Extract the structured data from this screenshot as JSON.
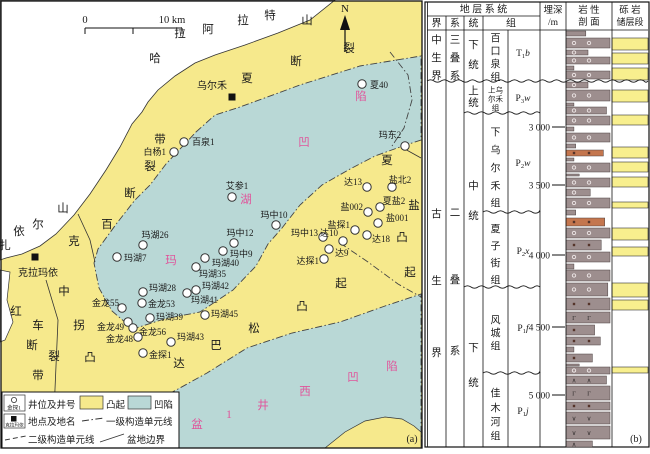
{
  "colors": {
    "uplift_yellow": "#f6e98c",
    "sag_blue": "#b9d8d6",
    "pink_label": "#e0559b",
    "congl_gray": "#9d8e8e",
    "congl_orange": "#c4764e",
    "reservoir_yellow": "#f8ef8e",
    "line_black": "#333333"
  },
  "map": {
    "panel_label": "(a)",
    "north_label": "N",
    "scale": {
      "zero": "0",
      "ten": "10 km"
    },
    "towns": [
      {
        "name": "乌尔禾",
        "x": 232,
        "y": 97,
        "lx": 212,
        "ly": 89
      },
      {
        "name": "克拉玛依",
        "x": 35,
        "y": 257,
        "lx": 38,
        "ly": 276
      }
    ],
    "wells": [
      {
        "n": "夏40",
        "x": 362,
        "y": 84,
        "lx": 370,
        "ly": 88,
        "a": "start"
      },
      {
        "n": "百泉1",
        "x": 184,
        "y": 142,
        "lx": 192,
        "ly": 145,
        "a": "start"
      },
      {
        "n": "白杨1",
        "x": 174,
        "y": 152,
        "lx": 166,
        "ly": 155,
        "a": "end"
      },
      {
        "n": "艾参1",
        "x": 232,
        "y": 197,
        "lx": 237,
        "ly": 189,
        "a": "middle"
      },
      {
        "n": "玛东2",
        "x": 405,
        "y": 146,
        "lx": 390,
        "ly": 138,
        "a": "middle"
      },
      {
        "n": "玛湖26",
        "x": 143,
        "y": 245,
        "lx": 155,
        "ly": 238,
        "a": "middle"
      },
      {
        "n": "玛中12",
        "x": 234,
        "y": 243,
        "lx": 240,
        "ly": 236,
        "a": "middle"
      },
      {
        "n": "玛中9",
        "x": 223,
        "y": 251,
        "lx": 230,
        "ly": 257,
        "a": "start"
      },
      {
        "n": "玛湖40",
        "x": 205,
        "y": 258,
        "lx": 212,
        "ly": 266,
        "a": "start"
      },
      {
        "n": "玛湖35",
        "x": 196,
        "y": 267,
        "lx": 199,
        "ly": 277,
        "a": "start"
      },
      {
        "n": "玛湖7",
        "x": 117,
        "y": 257,
        "lx": 124,
        "ly": 261,
        "a": "start"
      },
      {
        "n": "玛湖28",
        "x": 143,
        "y": 292,
        "lx": 149,
        "ly": 291,
        "a": "start"
      },
      {
        "n": "玛湖42",
        "x": 196,
        "y": 290,
        "lx": 202,
        "ly": 289,
        "a": "start"
      },
      {
        "n": "玛湖41",
        "x": 187,
        "y": 293,
        "lx": 191,
        "ly": 303,
        "a": "start"
      },
      {
        "n": "金龙55",
        "x": 122,
        "y": 308,
        "lx": 119,
        "ly": 306,
        "a": "end"
      },
      {
        "n": "金龙53",
        "x": 142,
        "y": 303,
        "lx": 148,
        "ly": 307,
        "a": "start"
      },
      {
        "n": "玛湖39",
        "x": 150,
        "y": 318,
        "lx": 156,
        "ly": 320,
        "a": "start"
      },
      {
        "n": "玛湖45",
        "x": 205,
        "y": 315,
        "lx": 211,
        "ly": 317,
        "a": "start"
      },
      {
        "n": "金龙49",
        "x": 128,
        "y": 322,
        "lx": 124,
        "ly": 330,
        "a": "end"
      },
      {
        "n": "金龙56",
        "x": 133,
        "y": 328,
        "lx": 139,
        "ly": 335,
        "a": "start"
      },
      {
        "n": "金龙48",
        "x": 138,
        "y": 337,
        "lx": 133,
        "ly": 342,
        "a": "end"
      },
      {
        "n": "玛湖43",
        "x": 171,
        "y": 342,
        "lx": 177,
        "ly": 340,
        "a": "start"
      },
      {
        "n": "金探1",
        "x": 143,
        "y": 353,
        "lx": 149,
        "ly": 358,
        "a": "start"
      },
      {
        "n": "玛中10",
        "x": 276,
        "y": 225,
        "lx": 274,
        "ly": 218,
        "a": "middle"
      },
      {
        "n": "玛中13",
        "x": 323,
        "y": 237,
        "lx": 318,
        "ly": 236,
        "a": "end"
      },
      {
        "n": "达13",
        "x": 367,
        "y": 187,
        "lx": 362,
        "ly": 185,
        "a": "end"
      },
      {
        "n": "盐北2",
        "x": 392,
        "y": 187,
        "lx": 400,
        "ly": 183,
        "a": "middle"
      },
      {
        "n": "盐002",
        "x": 368,
        "y": 212,
        "lx": 363,
        "ly": 210,
        "a": "end"
      },
      {
        "n": "夏盐2",
        "x": 380,
        "y": 207,
        "lx": 394,
        "ly": 204,
        "a": "middle"
      },
      {
        "n": "盐001",
        "x": 378,
        "y": 223,
        "lx": 386,
        "ly": 221,
        "a": "start"
      },
      {
        "n": "盐探1",
        "x": 355,
        "y": 230,
        "lx": 350,
        "ly": 228,
        "a": "end"
      },
      {
        "n": "达10",
        "x": 343,
        "y": 241,
        "lx": 338,
        "ly": 236,
        "a": "end"
      },
      {
        "n": "达18",
        "x": 367,
        "y": 235,
        "lx": 372,
        "ly": 242,
        "a": "start"
      },
      {
        "n": "达9",
        "x": 329,
        "y": 249,
        "lx": 335,
        "ly": 256,
        "a": "start"
      },
      {
        "n": "达探1",
        "x": 324,
        "y": 259,
        "lx": 319,
        "ly": 264,
        "a": "end"
      }
    ],
    "labels": [
      {
        "t": "哈",
        "x": 155,
        "y": 62,
        "c": "k"
      },
      {
        "t": "拉",
        "x": 180,
        "y": 37,
        "c": "k"
      },
      {
        "t": "阿",
        "x": 208,
        "y": 33,
        "c": "k"
      },
      {
        "t": "拉",
        "x": 243,
        "y": 24,
        "c": "k"
      },
      {
        "t": "特",
        "x": 270,
        "y": 19,
        "c": "k"
      },
      {
        "t": "山",
        "x": 307,
        "y": 24,
        "c": "k"
      },
      {
        "t": "扎",
        "x": 5,
        "y": 249,
        "c": "k"
      },
      {
        "t": "依",
        "x": 19,
        "y": 235,
        "c": "k"
      },
      {
        "t": "尔",
        "x": 38,
        "y": 228,
        "c": "k"
      },
      {
        "t": "山",
        "x": 63,
        "y": 212,
        "c": "k"
      },
      {
        "t": "克",
        "x": 74,
        "y": 245,
        "c": "k"
      },
      {
        "t": "百",
        "x": 107,
        "y": 228,
        "c": "k"
      },
      {
        "t": "断",
        "x": 130,
        "y": 197,
        "c": "k"
      },
      {
        "t": "裂",
        "x": 150,
        "y": 170,
        "c": "k"
      },
      {
        "t": "带",
        "x": 160,
        "y": 143,
        "c": "k"
      },
      {
        "t": "夏",
        "x": 247,
        "y": 82,
        "c": "k"
      },
      {
        "t": "断",
        "x": 296,
        "y": 65,
        "c": "k"
      },
      {
        "t": "裂",
        "x": 349,
        "y": 52,
        "c": "k"
      },
      {
        "t": "红",
        "x": 16,
        "y": 315,
        "c": "k"
      },
      {
        "t": "车",
        "x": 38,
        "y": 329,
        "c": "k"
      },
      {
        "t": "断",
        "x": 32,
        "y": 349,
        "c": "k"
      },
      {
        "t": "裂",
        "x": 54,
        "y": 360,
        "c": "k"
      },
      {
        "t": "带",
        "x": 38,
        "y": 379,
        "c": "k"
      },
      {
        "t": "中",
        "x": 64,
        "y": 295,
        "c": "k"
      },
      {
        "t": "拐",
        "x": 79,
        "y": 329,
        "c": "k"
      },
      {
        "t": "凸",
        "x": 90,
        "y": 361,
        "c": "k"
      },
      {
        "t": "夏",
        "x": 387,
        "y": 164,
        "c": "k"
      },
      {
        "t": "盐",
        "x": 414,
        "y": 209,
        "c": "k"
      },
      {
        "t": "凸",
        "x": 402,
        "y": 241,
        "c": "k"
      },
      {
        "t": "起",
        "x": 410,
        "y": 276,
        "c": "k"
      },
      {
        "t": "达",
        "x": 179,
        "y": 367,
        "c": "k"
      },
      {
        "t": "巴",
        "x": 216,
        "y": 349,
        "c": "k"
      },
      {
        "t": "松",
        "x": 254,
        "y": 332,
        "c": "k"
      },
      {
        "t": "凸",
        "x": 302,
        "y": 310,
        "c": "k"
      },
      {
        "t": "起",
        "x": 341,
        "y": 287,
        "c": "k"
      },
      {
        "t": "玛",
        "x": 171,
        "y": 264,
        "c": "p"
      },
      {
        "t": "湖",
        "x": 246,
        "y": 203,
        "c": "p"
      },
      {
        "t": "凹",
        "x": 304,
        "y": 146,
        "c": "p"
      },
      {
        "t": "陷",
        "x": 361,
        "y": 100,
        "c": "p"
      },
      {
        "t": "盆",
        "x": 197,
        "y": 428,
        "c": "p"
      },
      {
        "t": "1",
        "x": 229,
        "y": 418,
        "c": "p"
      },
      {
        "t": "井",
        "x": 263,
        "y": 409,
        "c": "p"
      },
      {
        "t": "西",
        "x": 305,
        "y": 395,
        "c": "p"
      },
      {
        "t": "凹",
        "x": 353,
        "y": 381,
        "c": "p"
      },
      {
        "t": "陷",
        "x": 392,
        "y": 370,
        "c": "p"
      }
    ],
    "legend": {
      "well_symbol_label": "金探1",
      "well_text": "井位及井号",
      "uplift_text": "凸起",
      "sag_text": "凹陷",
      "town_symbol_label": "克拉玛依",
      "town_text": "地点及地名",
      "l1_text": "一级构造单元线",
      "l2_text": "二级构造单元线",
      "basin_text": "盆地边界"
    }
  },
  "column": {
    "panel_label": "(b)",
    "header": {
      "strata": "地 层 系 统",
      "era": "界",
      "system": "系",
      "series": "统",
      "formation": "组",
      "depth": "埋深",
      "depth_unit": "/m",
      "lith1": "岩 性",
      "lith2": "剖 面",
      "res1": "砾 岩",
      "res2": "储层段"
    },
    "eras": [
      {
        "name": "中生界",
        "chars": [
          "中",
          "生",
          "界"
        ],
        "ys": [
          39,
          57,
          75
        ]
      },
      {
        "name": "古生界",
        "chars": [
          "古",
          "生",
          "界"
        ],
        "ys": [
          213,
          280,
          352
        ]
      }
    ],
    "systems": [
      {
        "name": "三叠系",
        "chars": [
          "三",
          "叠",
          "系"
        ],
        "ys": [
          39,
          57,
          75
        ]
      },
      {
        "name": "二叠系",
        "chars": [
          "二",
          "叠",
          "系"
        ],
        "ys": [
          212,
          279,
          350
        ]
      }
    ],
    "series": [
      {
        "name": "下统",
        "chars": [
          "下",
          "统"
        ],
        "ys": [
          44,
          64
        ]
      },
      {
        "name": "上统",
        "chars": [
          "上",
          "统"
        ],
        "ys": [
          90,
          102
        ]
      },
      {
        "name": "中统",
        "chars": [
          "中",
          "统"
        ],
        "ys": [
          185,
          215
        ]
      },
      {
        "name": "下统",
        "chars": [
          "下",
          "统"
        ],
        "ys": [
          347,
          382
        ]
      }
    ],
    "formations": [
      {
        "name": "百口泉组",
        "chars": [
          "百",
          "口",
          "泉",
          "组"
        ],
        "ys": [
          38,
          51,
          64,
          77
        ],
        "code": [
          "T",
          "1",
          "b"
        ],
        "cy": 53,
        "small": false
      },
      {
        "name": "上乌尔禾组",
        "chars": [
          "上乌",
          "尔禾",
          "组"
        ],
        "ys": [
          89,
          98,
          107
        ],
        "code": [
          "P",
          "3",
          "w"
        ],
        "cy": 98,
        "small": true
      },
      {
        "name": "下乌尔禾组",
        "chars": [
          "下",
          "乌",
          "尔",
          "禾",
          "组"
        ],
        "ys": [
          132,
          150,
          168,
          186,
          203
        ],
        "code": [
          "P",
          "2",
          "w"
        ],
        "cy": 163,
        "small": false
      },
      {
        "name": "夏子街组",
        "chars": [
          "夏",
          "子",
          "街",
          "组"
        ],
        "ys": [
          229,
          246,
          263,
          280
        ],
        "code": [
          "P",
          "2",
          "x"
        ],
        "cy": 251,
        "small": false
      },
      {
        "name": "风城组",
        "chars": [
          "风",
          "城",
          "组"
        ],
        "ys": [
          320,
          333,
          346
        ],
        "code": [
          "P",
          "1",
          "f"
        ],
        "cy": 328,
        "small": false
      },
      {
        "name": "佳木河组",
        "chars": [
          "佳",
          "木",
          "河",
          "组"
        ],
        "ys": [
          393,
          408,
          422,
          436
        ],
        "code": [
          "P",
          "1",
          "j"
        ],
        "cy": 411,
        "small": false
      }
    ],
    "depth_ticks": [
      {
        "label": "3 000",
        "y": 127
      },
      {
        "label": "3 500",
        "y": 185
      },
      {
        "label": "4 000",
        "y": 255
      },
      {
        "label": "4 500",
        "y": 327
      },
      {
        "label": "5 000",
        "y": 395
      }
    ],
    "wavy_lines": [
      {
        "y": 81,
        "x0": 427,
        "x1": 648
      },
      {
        "y": 113,
        "x0": 464,
        "x1": 540
      },
      {
        "y": 212,
        "x0": 483,
        "x1": 540
      },
      {
        "y": 287,
        "x0": 464,
        "x1": 540
      },
      {
        "y": 373,
        "x0": 483,
        "x1": 540
      }
    ],
    "beds": [
      [
        31,
        36,
        "g",
        0.45,
        ""
      ],
      [
        38,
        48,
        "g",
        1,
        "o"
      ],
      [
        50,
        55,
        "g",
        0.5,
        "o"
      ],
      [
        57,
        64,
        "g",
        1,
        "o"
      ],
      [
        66,
        70,
        "g",
        0.18,
        ""
      ],
      [
        71,
        79,
        "g",
        1,
        "o"
      ],
      [
        82,
        88,
        "g",
        0.5,
        "o"
      ],
      [
        90,
        101,
        "g",
        1,
        "o"
      ],
      [
        103,
        106,
        "g",
        0.18,
        ""
      ],
      [
        107,
        114,
        "g",
        0.92,
        "o"
      ],
      [
        116,
        125,
        "g",
        1,
        "o"
      ],
      [
        127,
        131,
        "g",
        0.18,
        ""
      ],
      [
        133,
        142,
        "g",
        1,
        "o"
      ],
      [
        144,
        148,
        "g",
        0.22,
        ""
      ],
      [
        150,
        156,
        "o",
        0.85,
        "d"
      ],
      [
        158,
        161,
        "g",
        0.18,
        ""
      ],
      [
        163,
        172,
        "g",
        1,
        "o"
      ],
      [
        174,
        176,
        "g",
        0.3,
        ""
      ],
      [
        178,
        187,
        "g",
        1,
        "o"
      ],
      [
        189,
        196,
        "g",
        0.55,
        "o"
      ],
      [
        198,
        208,
        "g",
        1,
        "o"
      ],
      [
        210,
        215,
        "g",
        0.22,
        ""
      ],
      [
        218,
        226,
        "o",
        0.88,
        "d"
      ],
      [
        228,
        238,
        "g",
        1,
        "o"
      ],
      [
        240,
        250,
        "g",
        0.8,
        "d"
      ],
      [
        252,
        262,
        "g",
        1,
        "o"
      ],
      [
        264,
        269,
        "g",
        0.18,
        ""
      ],
      [
        270,
        281,
        "g",
        1,
        "o"
      ],
      [
        283,
        296,
        "g",
        0.95,
        "o"
      ],
      [
        298,
        310,
        "g",
        1,
        "d"
      ],
      [
        312,
        323,
        "g",
        1,
        "G"
      ],
      [
        325,
        335,
        "g",
        0.65,
        "d"
      ],
      [
        337,
        345,
        "g",
        0.78,
        "d"
      ],
      [
        347,
        352,
        "g",
        0.18,
        ""
      ],
      [
        354,
        362,
        "g",
        0.6,
        "d"
      ],
      [
        364,
        366,
        "g",
        0.3,
        ""
      ],
      [
        367,
        374,
        "g",
        1,
        "o"
      ],
      [
        376,
        384,
        "g",
        0.92,
        "^"
      ],
      [
        386,
        400,
        "g",
        1,
        "G"
      ],
      [
        402,
        410,
        "g",
        1,
        "d"
      ],
      [
        412,
        424,
        "g",
        1,
        "v"
      ],
      [
        426,
        439,
        "g",
        1,
        "v"
      ],
      [
        441,
        447,
        "g",
        0.6,
        "^"
      ]
    ],
    "reservoir_blocks": [
      [
        38,
        50
      ],
      [
        53,
        64
      ],
      [
        68,
        80
      ],
      [
        90,
        102
      ],
      [
        115,
        125
      ],
      [
        147,
        158
      ],
      [
        162,
        172
      ],
      [
        177,
        187
      ],
      [
        202,
        208
      ],
      [
        228,
        240
      ],
      [
        247,
        256
      ],
      [
        283,
        297
      ],
      [
        300,
        310
      ],
      [
        367,
        373
      ]
    ]
  }
}
